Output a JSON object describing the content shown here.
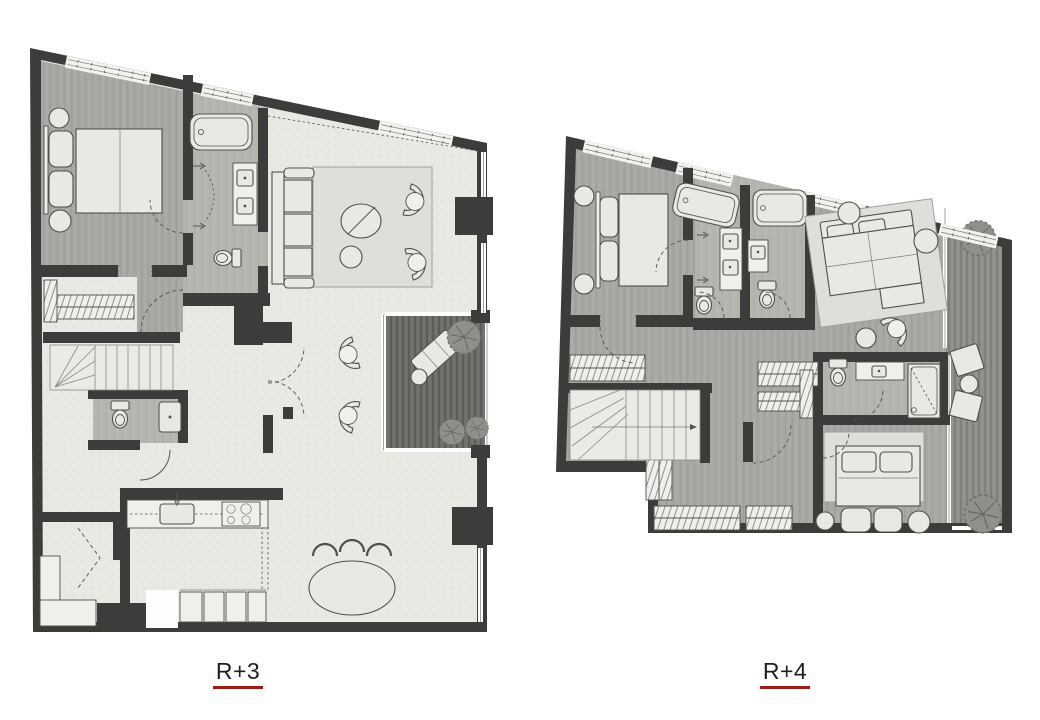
{
  "sheet": {
    "background": "#ffffff",
    "description_visible_text_only": true
  },
  "plans": [
    {
      "id": "r-plus-3",
      "label": "R+3"
    },
    {
      "id": "r-plus-4",
      "label": "R+4"
    }
  ],
  "label_style": {
    "text_color": "#1e1e1e",
    "underline_color": "#9e1b18"
  },
  "palette": {
    "bg": "#ffffff",
    "wall": "#3d3c3a",
    "floor-light": "#eae8e3",
    "floor-wood": "#a8a7a3",
    "floor-wood2": "#b6b4af",
    "deck-dark": "#6f6e68",
    "deck-mid": "#8f8e88",
    "furn": "#e9e8e4",
    "furn-stroke": "#50504b",
    "line": "#54534e",
    "rug": "#dfdeda",
    "window": "#f3f2ee",
    "label": "#1e1e1e",
    "underline": "#9e1b18"
  }
}
